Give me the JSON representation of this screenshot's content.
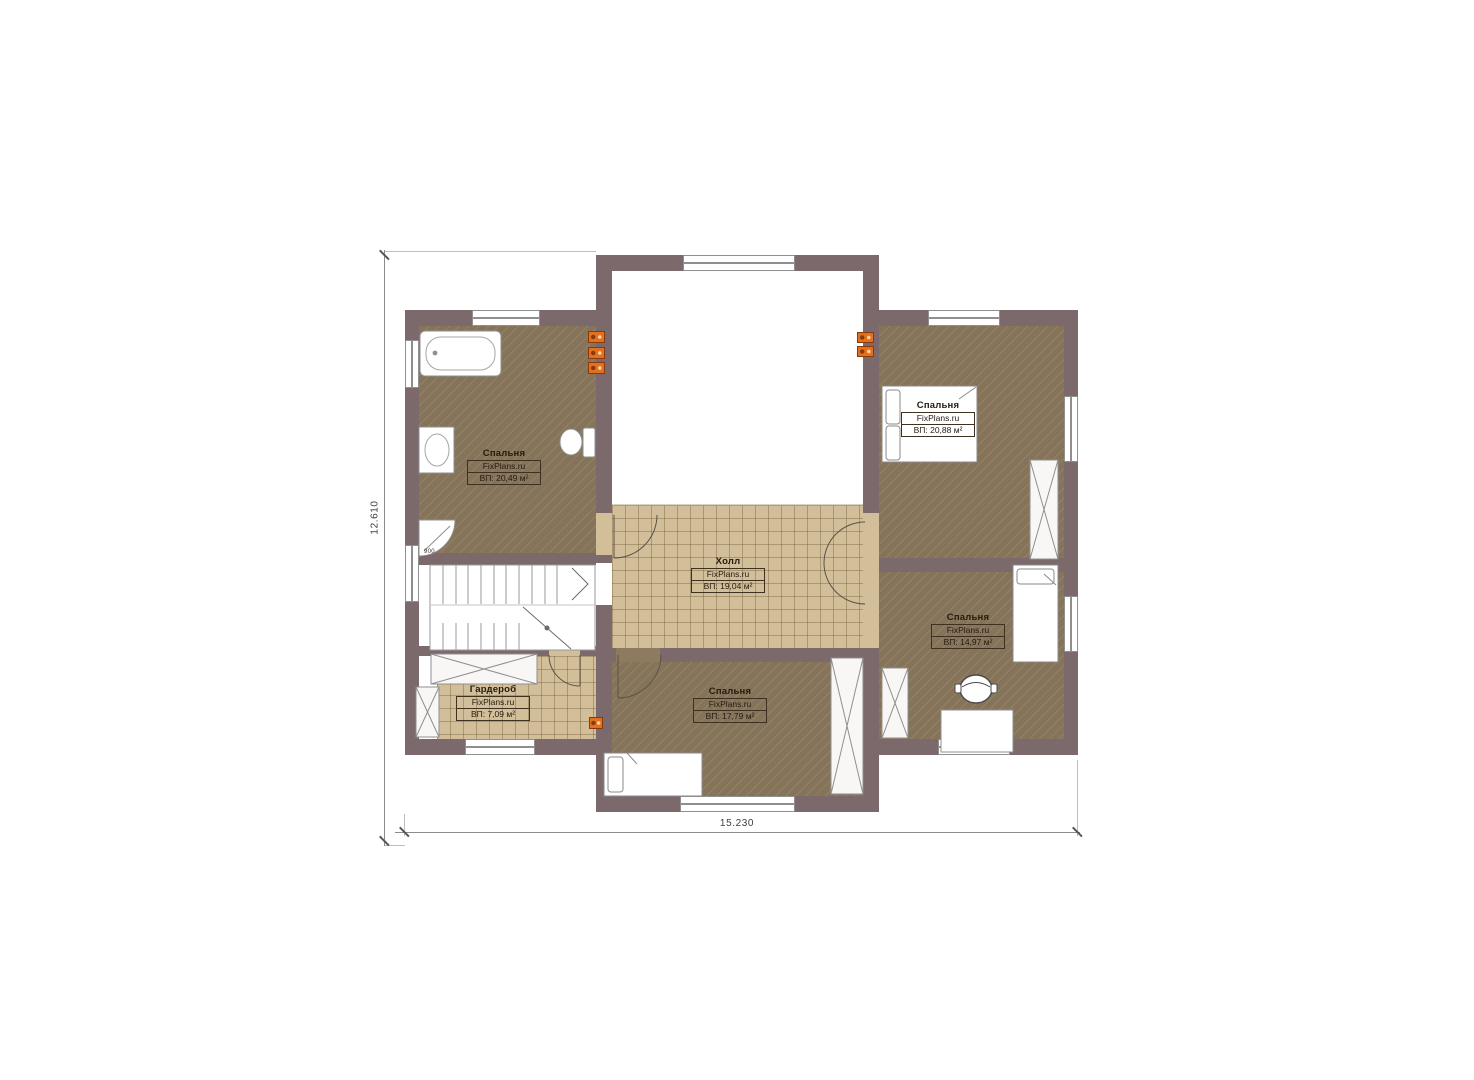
{
  "plan": {
    "watermark": "FixPlans.ru",
    "dimension_height": "12.610",
    "dimension_width": "15.230",
    "shower_size": "900",
    "rooms": [
      {
        "key": "bedroom-left",
        "name": "Спальня",
        "area": "ВП: 20,49 м²"
      },
      {
        "key": "hall",
        "name": "Холл",
        "area": "ВП: 19,04 м²"
      },
      {
        "key": "bedroom-top-right",
        "name": "Спальня",
        "area": "ВП: 20,88 м²"
      },
      {
        "key": "bedroom-bottom-right",
        "name": "Спальня",
        "area": "ВП: 14,97 м²"
      },
      {
        "key": "bedroom-bottom-center",
        "name": "Спальня",
        "area": "ВП: 17,79 м²"
      },
      {
        "key": "wardrobe",
        "name": "Гардероб",
        "area": "ВП: 7,09 м²"
      }
    ],
    "colors": {
      "wall": "#7b696c",
      "floor_wood": "#8d7a5f",
      "floor_tile": "#d2bf9a",
      "vent_marker": "#e2711f"
    }
  }
}
